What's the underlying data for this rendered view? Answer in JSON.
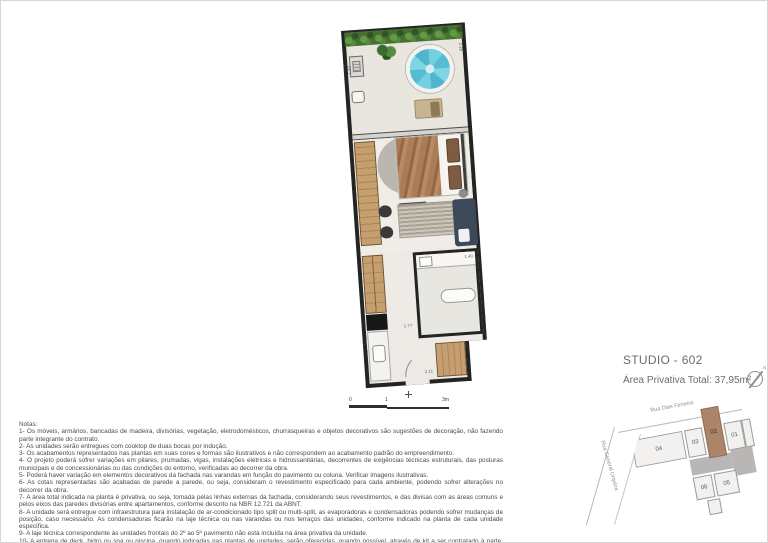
{
  "title_block": {
    "title": "STUDIO - 602",
    "area": "Área Privativa Total: 37,95m²",
    "north_letter": "N"
  },
  "plan": {
    "dimensions": {
      "left_top": "1.40",
      "right_top": "2.29",
      "bathroom": "1.40",
      "hall": "1.77",
      "bottom": "2.11"
    },
    "scale": [
      "0",
      "1",
      "3m"
    ],
    "colors": {
      "wall": "#242424",
      "pool": "#5fc4d8",
      "wood": "#bd9a6d",
      "sofa": "#3c4958",
      "hedge": "#46702f"
    }
  },
  "keyplan": {
    "streets": {
      "top": "Rua Dias Ferreira",
      "left": "Rua General Urquiza"
    },
    "units": [
      {
        "label": "04",
        "highlighted": false
      },
      {
        "label": "03",
        "highlighted": false
      },
      {
        "label": "02",
        "highlighted": true
      },
      {
        "label": "01",
        "highlighted": false
      },
      {
        "label": "06",
        "highlighted": false
      },
      {
        "label": "05",
        "highlighted": false
      }
    ],
    "highlight_color": "#ab8469"
  },
  "notes": {
    "heading": "Notas:",
    "items": [
      "1- Os móveis, armários, bancadas de madeira, divisórias, vegetação, eletrodomésticos, churrasqueiras e objetos decorativos são sugestões de decoração, não fazendo parte integrante do contrato.",
      "2- As unidades serão entregues com cooktop de duas bocas por indução.",
      "3- Os acabamentos  representados nas plantas em suas cores e formas são ilustrativos e não  correspondem ao acabamento padrão do  empreendimento.",
      "4- O projeto poderá sofrer variações em pilares,  prumadas,  vigas,  instalações elétricas e hidrossanitárias,  decorrentes de exigências técnicas estruturais, das posturas municipais e de concessionárias ou das condições do entorno, verificadas ao decorrer da obra.",
      "5- Poderá haver variação em elementos decorativos da fachada nas varandas em função do pavimento ou coluna. Verificar imagens ilustrativas.",
      "6- As  cotas  representadas  são  acabadas  de parede  a  parede, ou seja,  consideram o revestimento  especificado para cada  ambiente,  podendo  sofrer alterações no decorrer da obra.",
      "7- A área  total indicada  na planta é privativa, ou seja,  tomada pelas linhas externas da fachada,  considerando seus revestimentos, e das divisas  com as áreas comuns e pelos eixos das paredes divisórias entre apartamentos, conforme descrito na NBR 12.721 da ABNT.",
      "8- A unidade será entregue com infraestrutura para instalação de ar-condicionado tipo split ou multi-split, as evaporadoras e condensadoras podendo sofrer mudanças  de posição, caso necessário.  As condensadoras ficarão na laje técnica ou  nas varandas ou nos terraços das unidades,  conforme indicado na planta de cada unidade específica.",
      "9- A laje técnica correspondente às unidades frontais do 2º ao 5º pavimento não está incluída na área privativa da unidade.",
      "10- A  entrega  de  deck,  hidro ou spa ou piscina,  quando  indicadas  nas plantas de unidades,  serão  oferecidas,  quando  possível,  através  de kit a  ser contratado à parte, podendo ter custo adicional."
    ]
  }
}
